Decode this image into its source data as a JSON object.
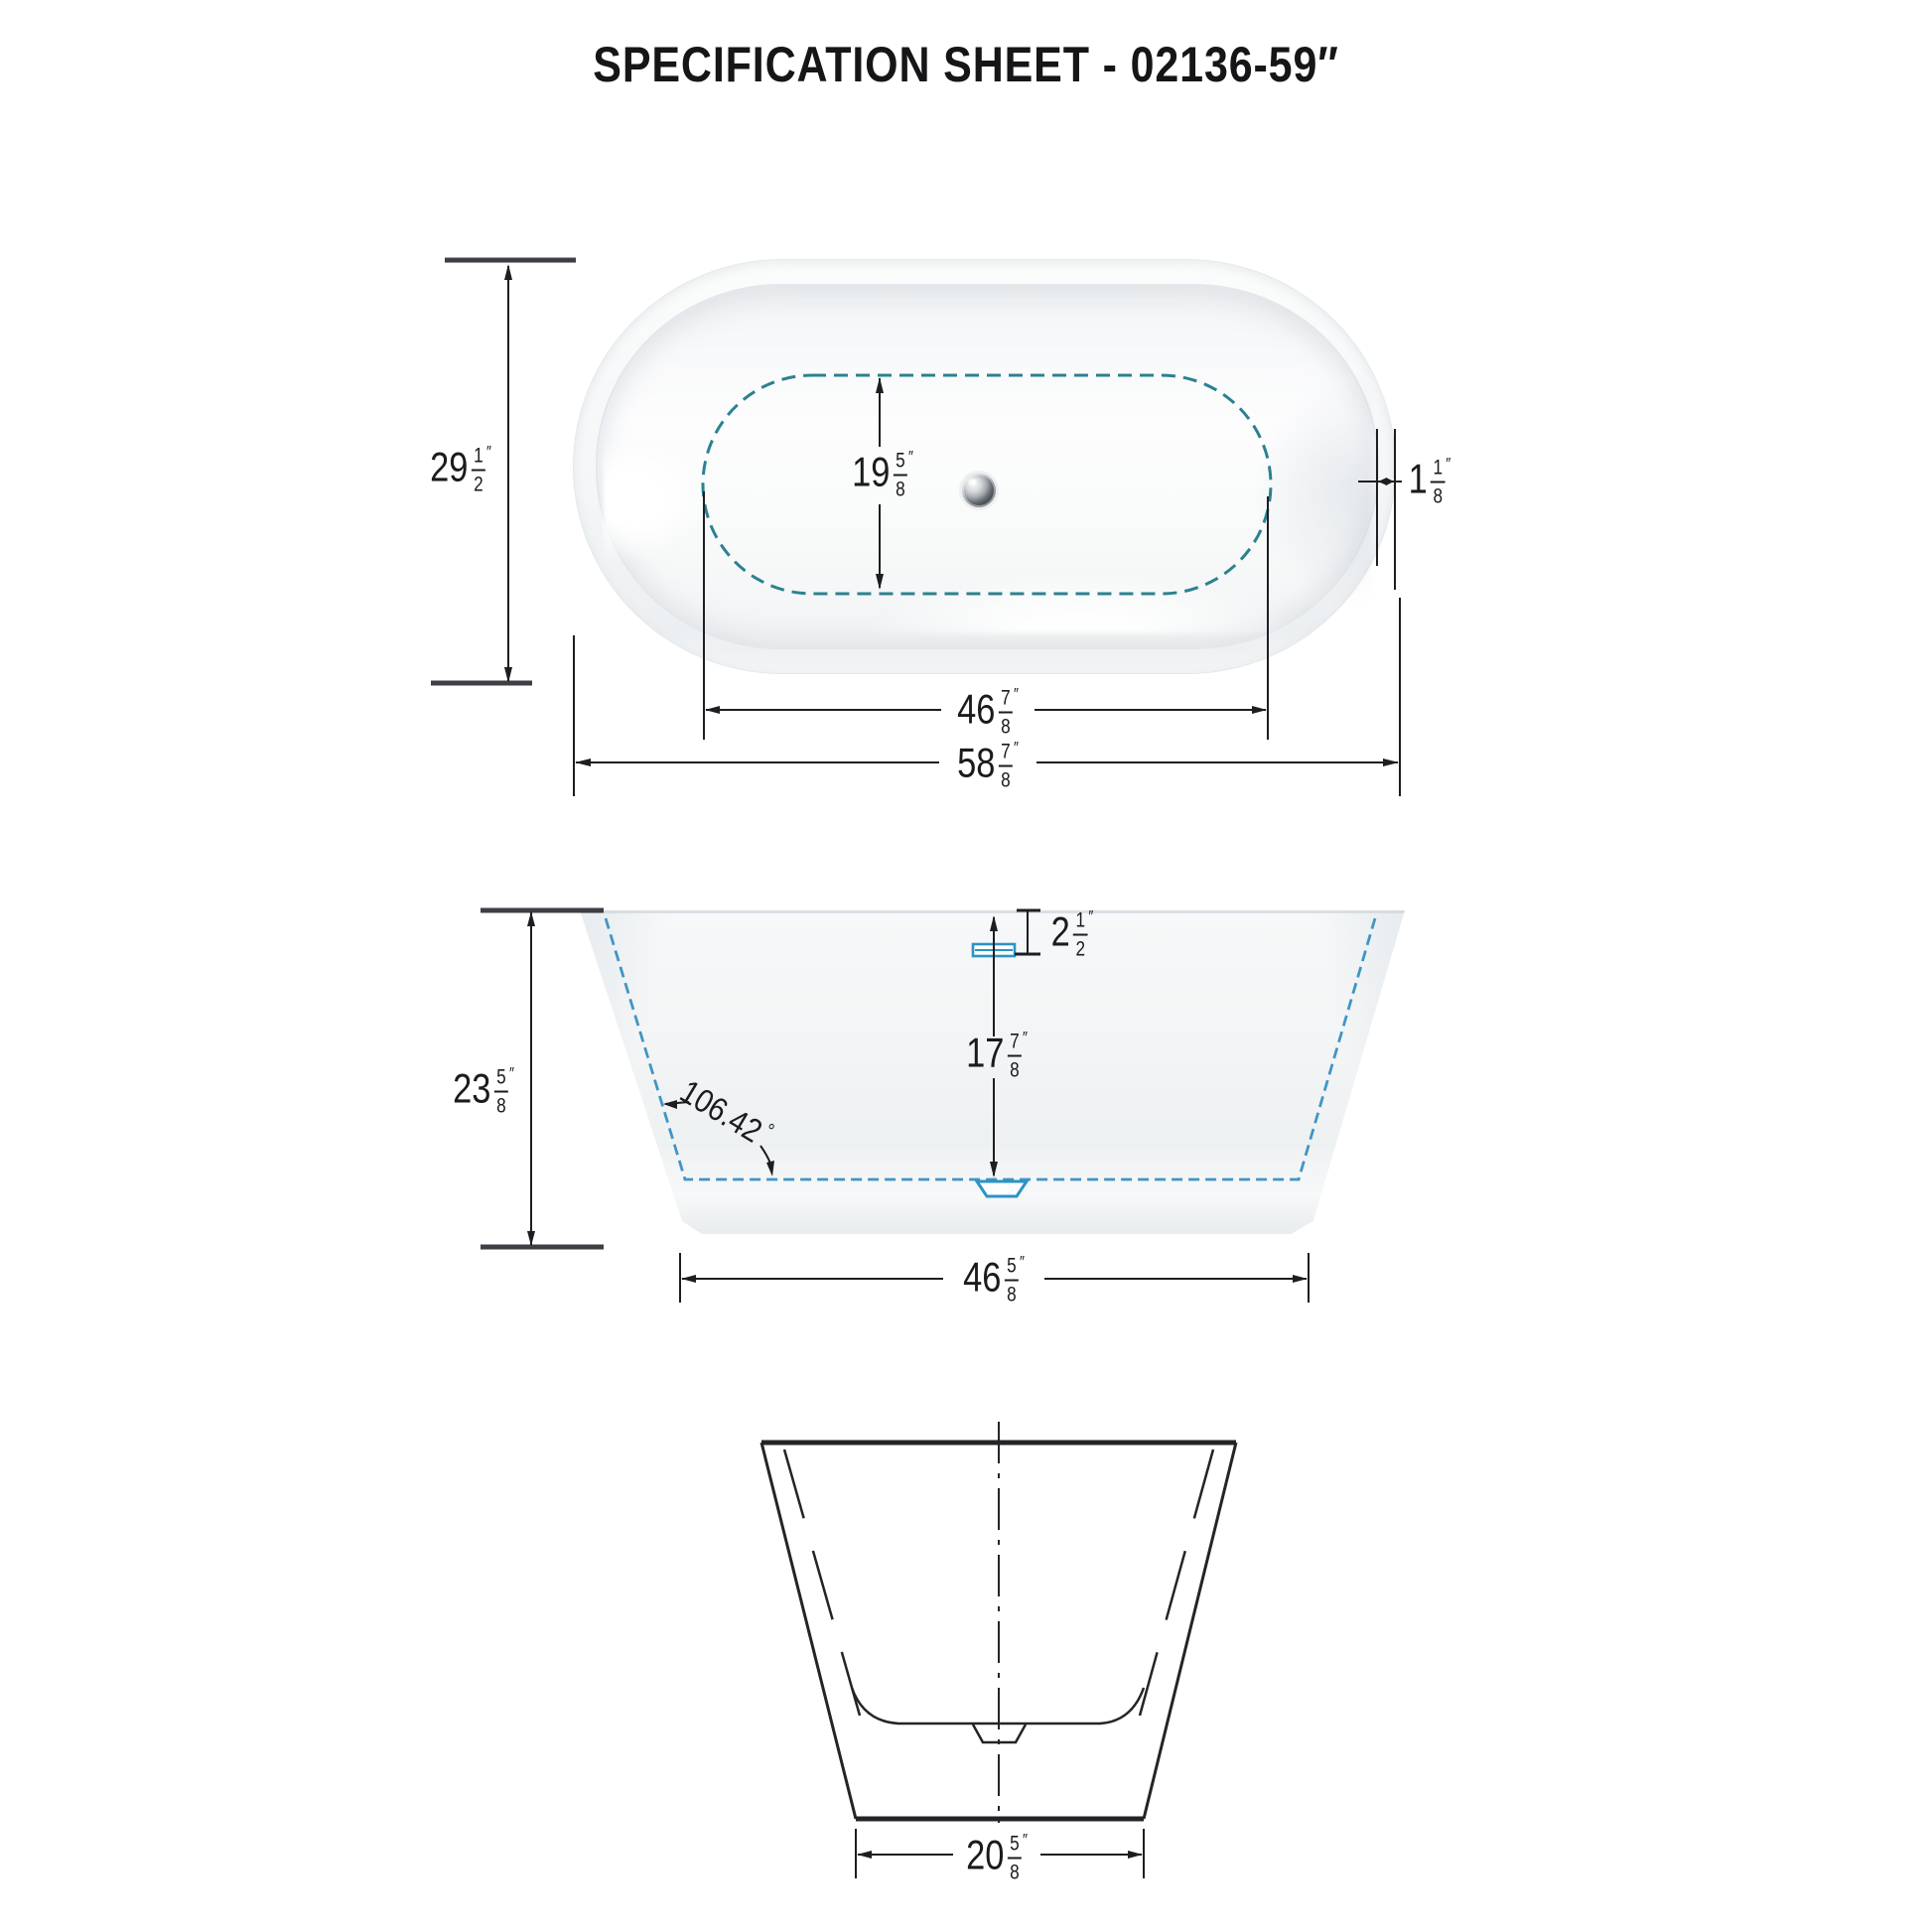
{
  "title": "SPECIFICATION SHEET - 02136-59″",
  "colors": {
    "dash_teal": "#2b8191",
    "dash_blue": "#4095c5",
    "fixture_blue": "#2e92c6",
    "line_dark": "#1e1e22",
    "tick_dark": "#3e3e44"
  },
  "dims": {
    "overall_width": {
      "whole": "29",
      "num": "1",
      "den": "2",
      "unit": "″"
    },
    "basin_width": {
      "whole": "19",
      "num": "5",
      "den": "8",
      "unit": "″"
    },
    "rim_thickness": {
      "whole": "1",
      "num": "1",
      "den": "8",
      "unit": "″"
    },
    "basin_length": {
      "whole": "46",
      "num": "7",
      "den": "8",
      "unit": "″"
    },
    "overall_length": {
      "whole": "58",
      "num": "7",
      "den": "8",
      "unit": "″"
    },
    "overflow_to_rim": {
      "whole": "2",
      "num": "1",
      "den": "2",
      "unit": "″"
    },
    "interior_depth": {
      "whole": "17",
      "num": "7",
      "den": "8",
      "unit": "″"
    },
    "overall_height": {
      "whole": "23",
      "num": "5",
      "den": "8",
      "unit": "″"
    },
    "wall_angle": {
      "value": "106.42",
      "unit": "°"
    },
    "base_length": {
      "whole": "46",
      "num": "5",
      "den": "8",
      "unit": "″"
    },
    "base_width": {
      "whole": "20",
      "num": "5",
      "den": "8",
      "unit": "″"
    }
  }
}
